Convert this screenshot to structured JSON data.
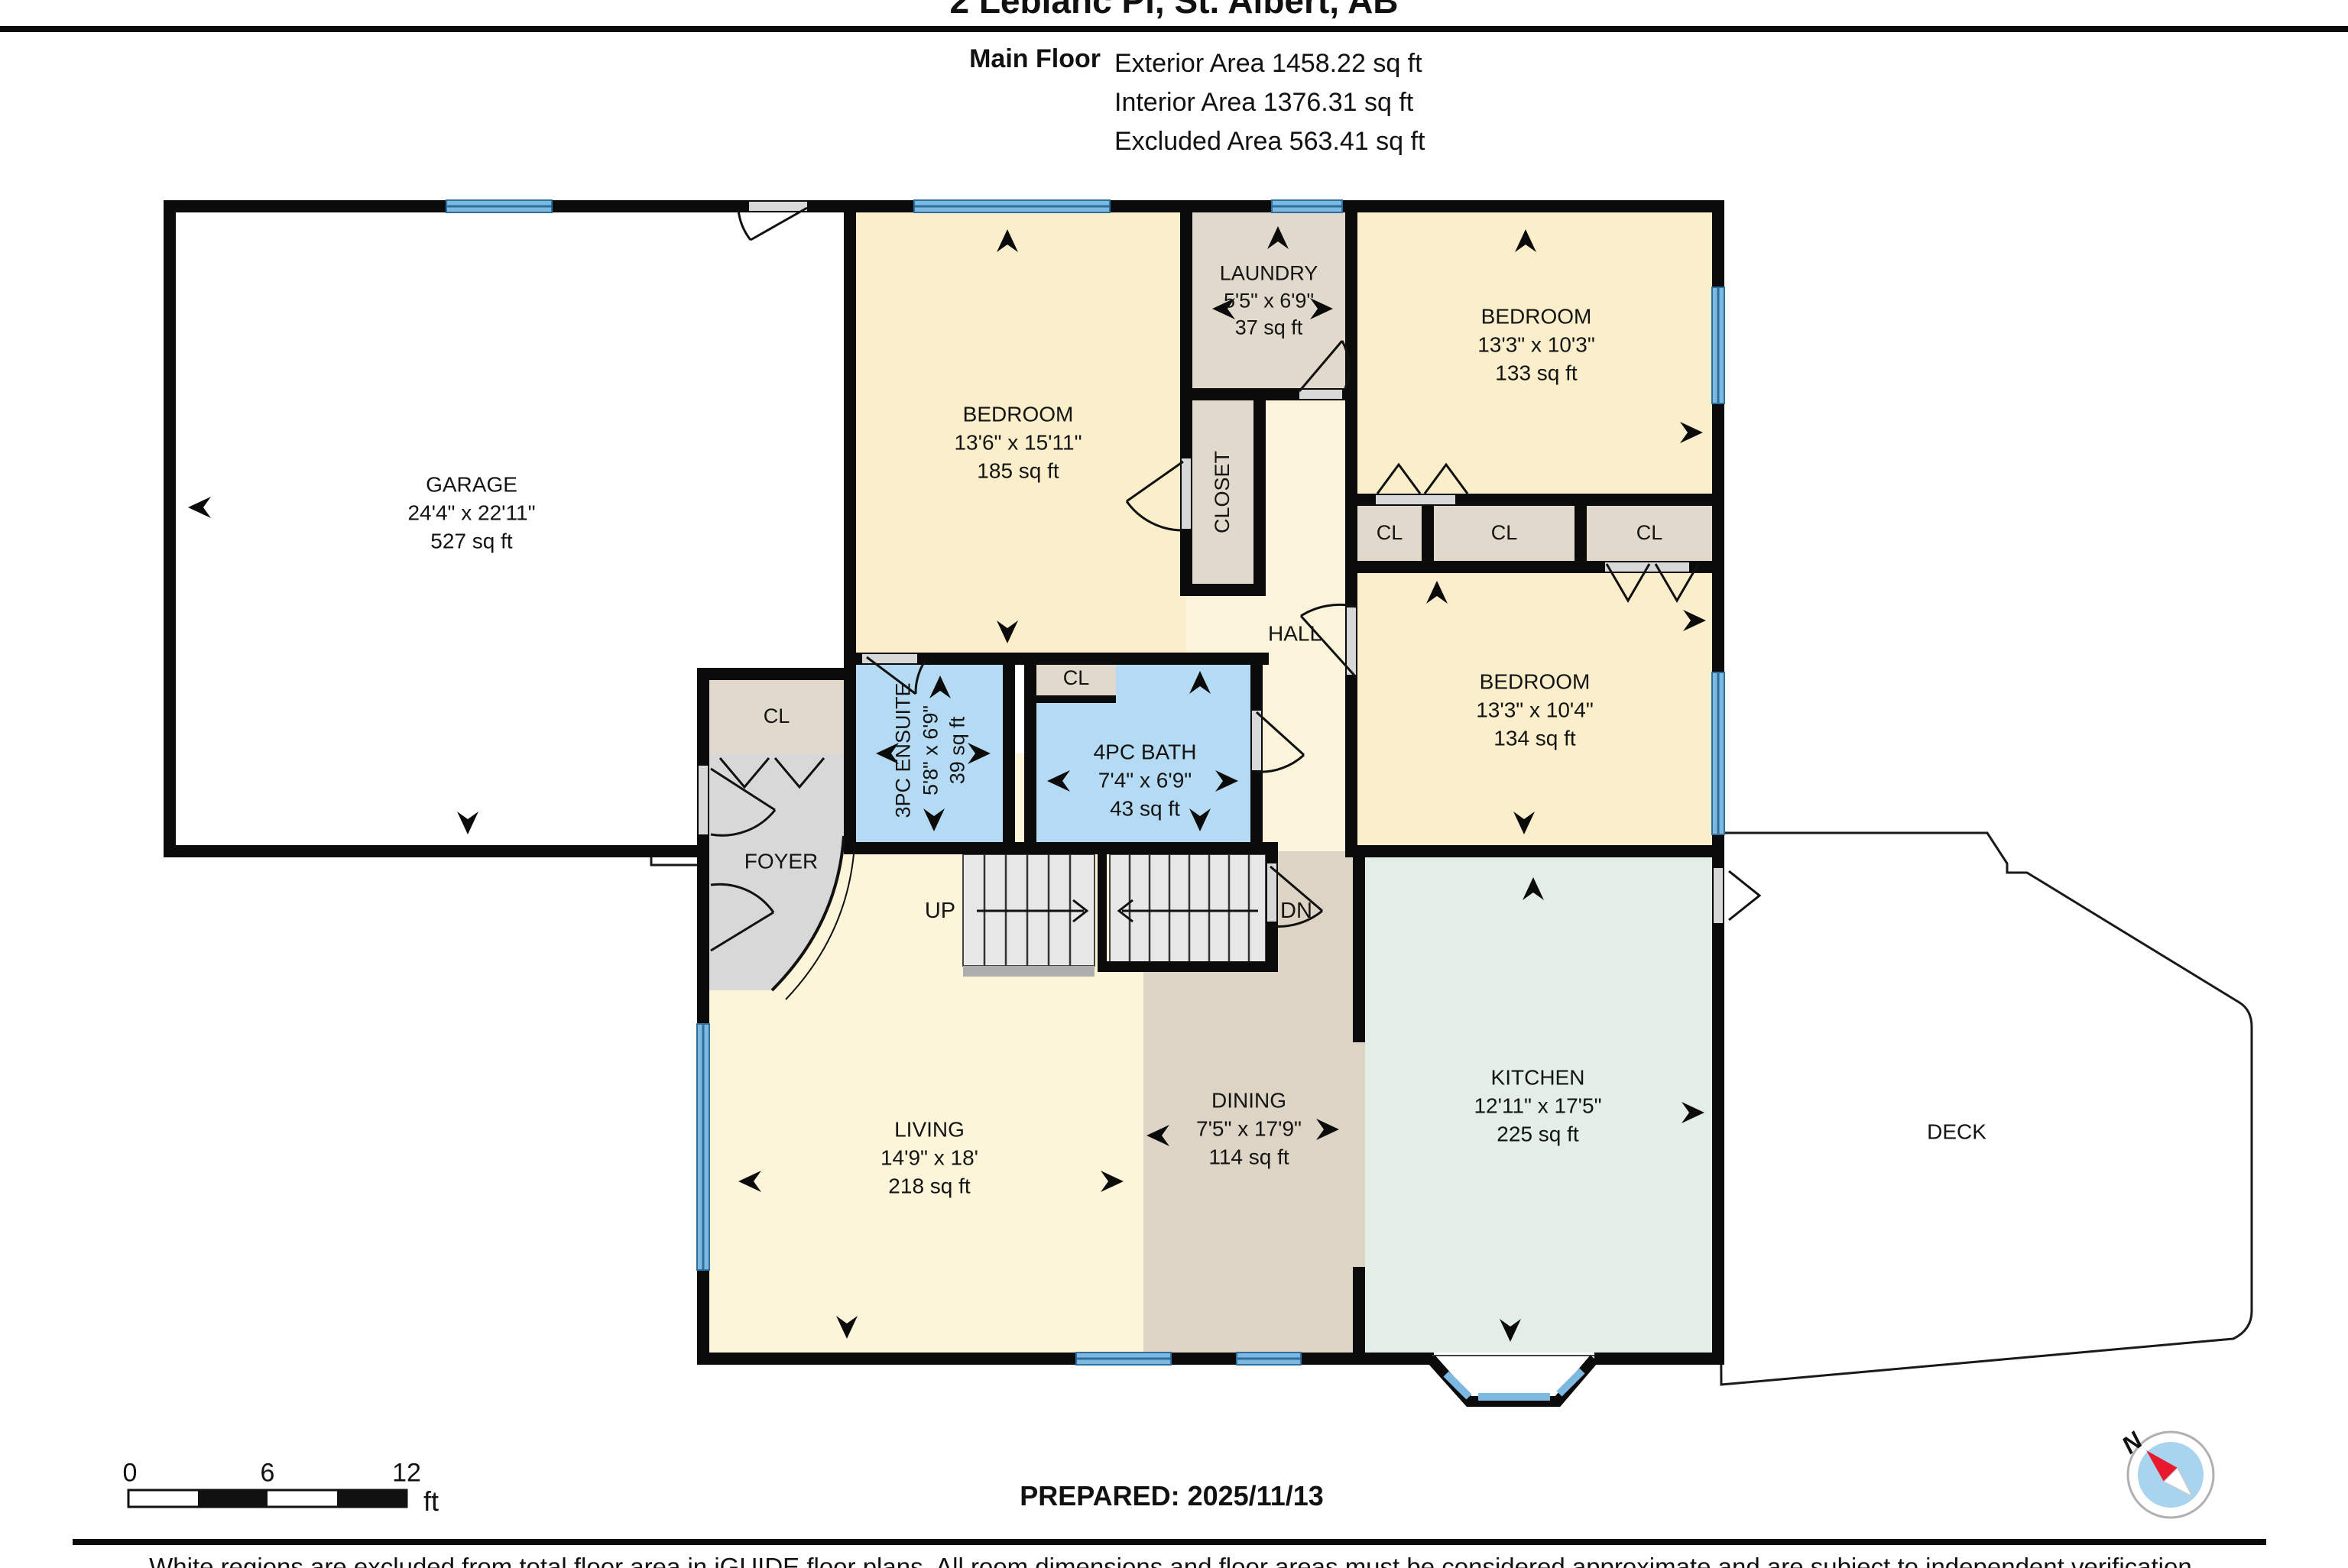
{
  "header": {
    "title": "2 Leblanc Pl, St. Albert, AB",
    "floor_label": "Main Floor",
    "stats": [
      "Exterior Area 1458.22 sq ft",
      "Interior Area 1376.31 sq ft",
      "Excluded Area 563.41 sq ft"
    ]
  },
  "rooms": {
    "garage": {
      "name": "GARAGE",
      "dims": "24'4\" x 22'11\"",
      "area": "527 sq ft"
    },
    "bedroom1": {
      "name": "BEDROOM",
      "dims": "13'6\" x 15'11\"",
      "area": "185 sq ft"
    },
    "laundry": {
      "name": "LAUNDRY",
      "dims": "5'5\" x 6'9\"",
      "area": "37 sq ft"
    },
    "bedroom2": {
      "name": "BEDROOM",
      "dims": "13'3\" x 10'3\"",
      "area": "133 sq ft"
    },
    "bedroom3": {
      "name": "BEDROOM",
      "dims": "13'3\" x 10'4\"",
      "area": "134 sq ft"
    },
    "ensuite": {
      "name": "3PC ENSUITE",
      "dims": "5'8\" x 6'9\"",
      "area": "39 sq ft"
    },
    "bath": {
      "name": "4PC BATH",
      "dims": "7'4\" x 6'9\"",
      "area": "43 sq ft"
    },
    "living": {
      "name": "LIVING",
      "dims": "14'9\" x 18'",
      "area": "218 sq ft"
    },
    "dining": {
      "name": "DINING",
      "dims": "7'5\" x 17'9\"",
      "area": "114 sq ft"
    },
    "kitchen": {
      "name": "KITCHEN",
      "dims": "12'11\" x 17'5\"",
      "area": "225 sq ft"
    }
  },
  "labels": {
    "hall": "HALL",
    "foyer": "FOYER",
    "closet": "CLOSET",
    "cl": "CL",
    "deck": "DECK",
    "up": "UP",
    "dn": "DN",
    "compass_north": "N"
  },
  "footer": {
    "scale_ticks": [
      "0",
      "6",
      "12"
    ],
    "scale_unit": "ft",
    "prepared": "PREPARED: 2025/11/13",
    "disclaimer": "White regions are excluded from total floor area in iGUIDE floor plans. All room dimensions and floor areas must be considered approximate and are subject to independent verification."
  }
}
